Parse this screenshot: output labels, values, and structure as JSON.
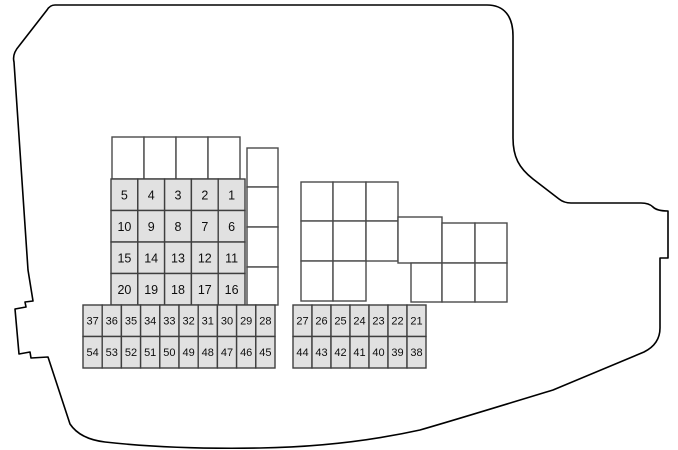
{
  "diagram": {
    "title": "engine-compartment-fuse-box-diagram",
    "colors": {
      "background": "#ffffff",
      "outline": "#000000",
      "cell_border": "#3f3f3f",
      "fuse_fill": "#e1e1e1",
      "relay_fill": "#ffffff",
      "number_color": "#0d0d0d"
    },
    "large_fuse_grid": {
      "x": 111,
      "y": 179,
      "col_width": 26.8,
      "row_height": 31.5,
      "font_size": 12.5,
      "rows": [
        [
          "5",
          "4",
          "3",
          "2",
          "1"
        ],
        [
          "10",
          "9",
          "8",
          "7",
          "6"
        ],
        [
          "15",
          "14",
          "13",
          "12",
          "11"
        ],
        [
          "20",
          "19",
          "18",
          "17",
          "16"
        ]
      ]
    },
    "small_fuse_grid_left": {
      "x": 83,
      "y": 305,
      "col_width": 19.2,
      "row_height": 31.5,
      "font_size": 11,
      "rows": [
        [
          "37",
          "36",
          "35",
          "34",
          "33",
          "32",
          "31",
          "30",
          "29",
          "28"
        ],
        [
          "54",
          "53",
          "52",
          "51",
          "50",
          "49",
          "48",
          "47",
          "46",
          "45"
        ]
      ]
    },
    "small_fuse_grid_right": {
      "x": 293,
      "y": 305,
      "col_width": 19,
      "row_height": 31.5,
      "font_size": 11,
      "rows": [
        [
          "27",
          "26",
          "25",
          "24",
          "23",
          "22",
          "21"
        ],
        [
          "44",
          "43",
          "42",
          "41",
          "40",
          "39",
          "38"
        ]
      ]
    },
    "relay_cells": [
      {
        "x": 112,
        "y": 137,
        "w": 32,
        "h": 42
      },
      {
        "x": 144,
        "y": 137,
        "w": 32,
        "h": 42
      },
      {
        "x": 176,
        "y": 137,
        "w": 32,
        "h": 42
      },
      {
        "x": 208,
        "y": 137,
        "w": 32,
        "h": 42
      },
      {
        "x": 247,
        "y": 148,
        "w": 31,
        "h": 39
      },
      {
        "x": 247,
        "y": 187,
        "w": 31,
        "h": 40
      },
      {
        "x": 247,
        "y": 227,
        "w": 31,
        "h": 40
      },
      {
        "x": 247,
        "y": 267,
        "w": 31,
        "h": 38
      },
      {
        "x": 301,
        "y": 182,
        "w": 32,
        "h": 39
      },
      {
        "x": 333,
        "y": 182,
        "w": 33,
        "h": 39
      },
      {
        "x": 366,
        "y": 182,
        "w": 32,
        "h": 39
      },
      {
        "x": 301,
        "y": 221,
        "w": 32,
        "h": 40
      },
      {
        "x": 333,
        "y": 221,
        "w": 33,
        "h": 40
      },
      {
        "x": 366,
        "y": 221,
        "w": 32,
        "h": 40
      },
      {
        "x": 301,
        "y": 261,
        "w": 32,
        "h": 40
      },
      {
        "x": 333,
        "y": 261,
        "w": 33,
        "h": 40
      },
      {
        "x": 398,
        "y": 217,
        "w": 44,
        "h": 46
      },
      {
        "x": 411,
        "y": 263,
        "w": 31,
        "h": 39
      },
      {
        "x": 442,
        "y": 223,
        "w": 33,
        "h": 40
      },
      {
        "x": 475,
        "y": 223,
        "w": 32,
        "h": 40
      },
      {
        "x": 442,
        "y": 263,
        "w": 33,
        "h": 39
      },
      {
        "x": 475,
        "y": 263,
        "w": 32,
        "h": 39
      }
    ]
  }
}
